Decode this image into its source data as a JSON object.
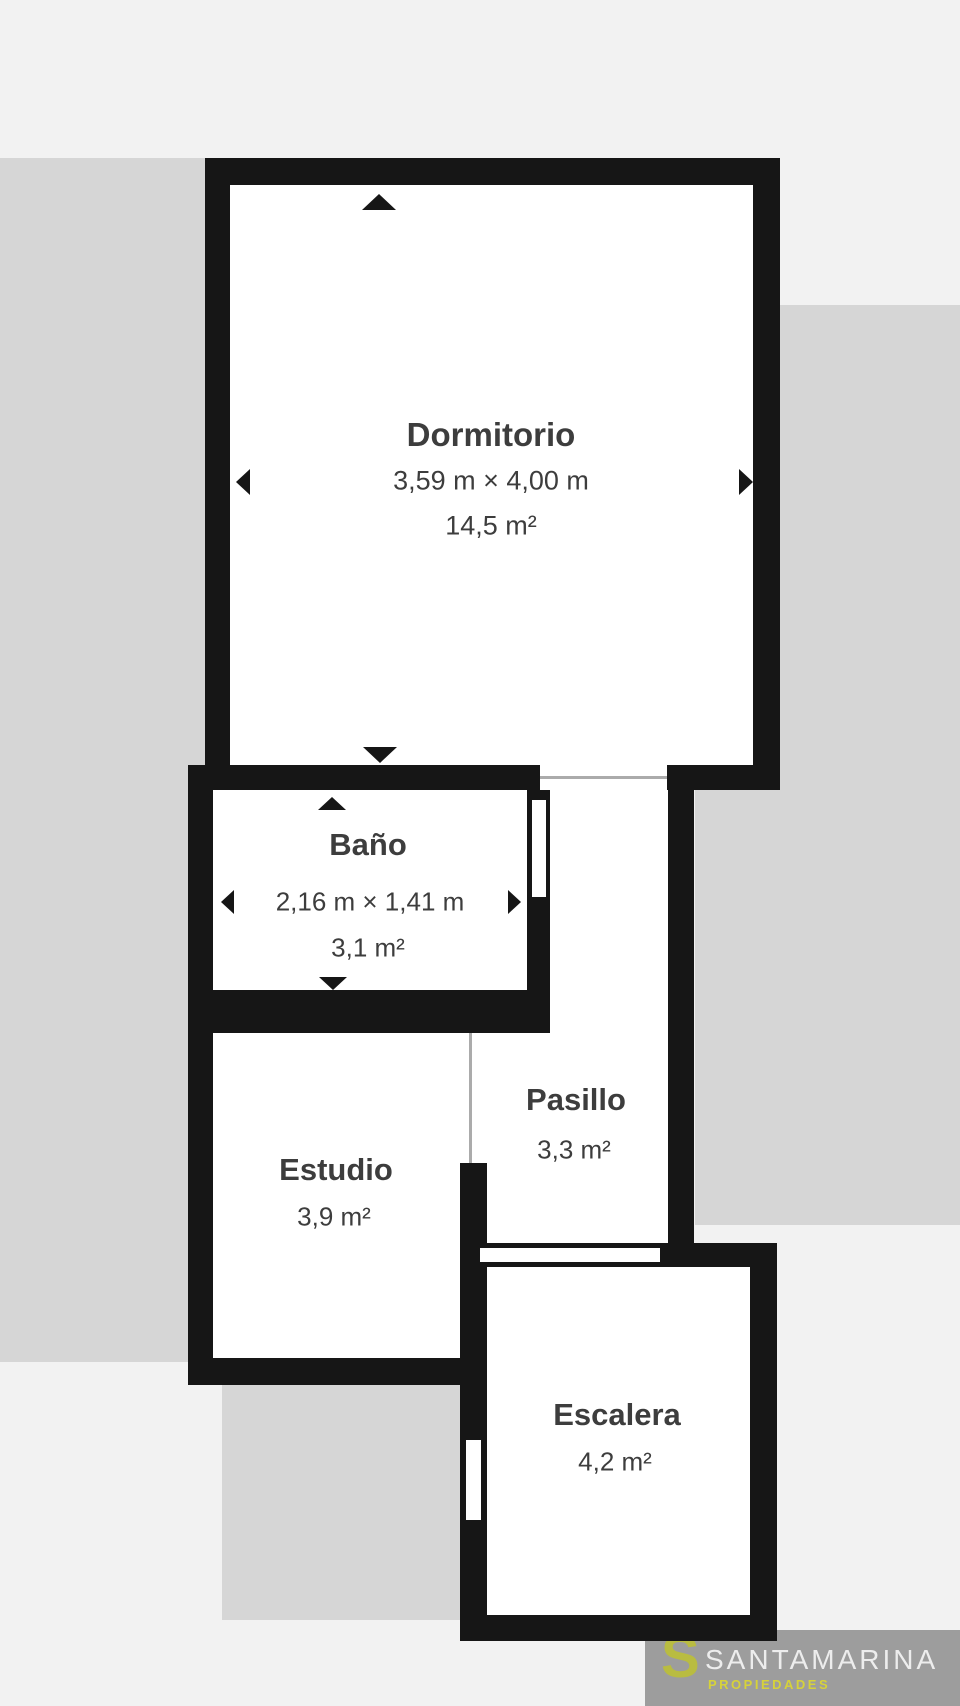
{
  "rooms": {
    "dormitorio": {
      "name": "Dormitorio",
      "dimensions": "3,59 m × 4,00 m",
      "area": "14,5 m²"
    },
    "bano": {
      "name": "Baño",
      "dimensions": "2,16 m × 1,41 m",
      "area": "3,1 m²"
    },
    "pasillo": {
      "name": "Pasillo",
      "area": "3,3 m²"
    },
    "estudio": {
      "name": "Estudio",
      "area": "3,9 m²"
    },
    "escalera": {
      "name": "Escalera",
      "area": "4,2 m²"
    }
  },
  "branding": {
    "logo_initial": "S",
    "company": "SANTAMARINA",
    "tagline": "PROPIEDADES"
  },
  "colors": {
    "background": "#f2f2f2",
    "adjacent_area": "#d6d6d6",
    "wall": "#161616",
    "room_fill": "#ffffff",
    "label_text": "#3d3d3d",
    "logo_background": "#9d9d9d",
    "logo_initial": "#b9bc41",
    "logo_company": "#ededed",
    "logo_tagline": "#d6d23a"
  }
}
